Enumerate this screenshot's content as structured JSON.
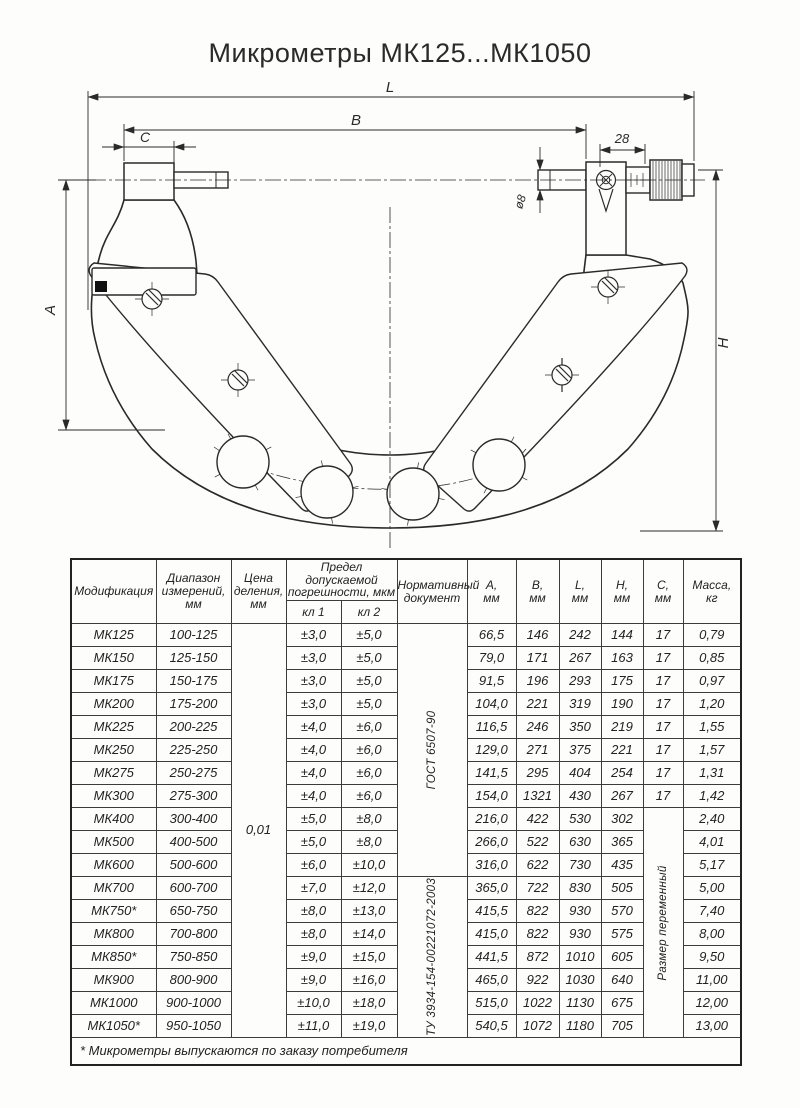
{
  "title": "Микрометры МК125...МК1050",
  "drawing": {
    "dim_L": "L",
    "dim_B": "B",
    "dim_C": "C",
    "dim_28": "28",
    "dim_d8": "ø8",
    "dim_A": "A",
    "dim_H": "H"
  },
  "table": {
    "headers": {
      "modification": "Модификация",
      "range": "Диапазон\nизмерений,\nмм",
      "division": "Цена\nделения,\nмм",
      "error_limit": "Предел допускаемой\nпогрешности, мкм",
      "class1": "кл 1",
      "class2": "кл 2",
      "document": "Нормативный\nдокумент",
      "a": "А,\nмм",
      "b": "В,\nмм",
      "l": "L,\nмм",
      "h": "Н,\nмм",
      "c": "С,\nмм",
      "mass": "Масса,\nкг"
    },
    "merged": {
      "price_division": "0,01",
      "doc1": {
        "label": "ГОСТ 6507-90",
        "rows": 11
      },
      "doc2": {
        "label": "ТУ 3934-154-00221072-2003",
        "rows": 7
      },
      "c_span": {
        "label": "Размер переменный",
        "start": 8,
        "rows": 10
      }
    },
    "rows": [
      {
        "mod": "МК125",
        "range": "100-125",
        "kl1": "±3,0",
        "kl2": "±5,0",
        "a": "66,5",
        "b": "146",
        "l": "242",
        "h": "144",
        "c": "17",
        "mass": "0,79"
      },
      {
        "mod": "МК150",
        "range": "125-150",
        "kl1": "±3,0",
        "kl2": "±5,0",
        "a": "79,0",
        "b": "171",
        "l": "267",
        "h": "163",
        "c": "17",
        "mass": "0,85"
      },
      {
        "mod": "МК175",
        "range": "150-175",
        "kl1": "±3,0",
        "kl2": "±5,0",
        "a": "91,5",
        "b": "196",
        "l": "293",
        "h": "175",
        "c": "17",
        "mass": "0,97"
      },
      {
        "mod": "МК200",
        "range": "175-200",
        "kl1": "±3,0",
        "kl2": "±5,0",
        "a": "104,0",
        "b": "221",
        "l": "319",
        "h": "190",
        "c": "17",
        "mass": "1,20"
      },
      {
        "mod": "МК225",
        "range": "200-225",
        "kl1": "±4,0",
        "kl2": "±6,0",
        "a": "116,5",
        "b": "246",
        "l": "350",
        "h": "219",
        "c": "17",
        "mass": "1,55"
      },
      {
        "mod": "МК250",
        "range": "225-250",
        "kl1": "±4,0",
        "kl2": "±6,0",
        "a": "129,0",
        "b": "271",
        "l": "375",
        "h": "221",
        "c": "17",
        "mass": "1,57"
      },
      {
        "mod": "МК275",
        "range": "250-275",
        "kl1": "±4,0",
        "kl2": "±6,0",
        "a": "141,5",
        "b": "295",
        "l": "404",
        "h": "254",
        "c": "17",
        "mass": "1,31"
      },
      {
        "mod": "МК300",
        "range": "275-300",
        "kl1": "±4,0",
        "kl2": "±6,0",
        "a": "154,0",
        "b": "1321",
        "l": "430",
        "h": "267",
        "c": "17",
        "mass": "1,42"
      },
      {
        "mod": "МК400",
        "range": "300-400",
        "kl1": "±5,0",
        "kl2": "±8,0",
        "a": "216,0",
        "b": "422",
        "l": "530",
        "h": "302",
        "c": null,
        "mass": "2,40"
      },
      {
        "mod": "МК500",
        "range": "400-500",
        "kl1": "±5,0",
        "kl2": "±8,0",
        "a": "266,0",
        "b": "522",
        "l": "630",
        "h": "365",
        "c": null,
        "mass": "4,01"
      },
      {
        "mod": "МК600",
        "range": "500-600",
        "kl1": "±6,0",
        "kl2": "±10,0",
        "a": "316,0",
        "b": "622",
        "l": "730",
        "h": "435",
        "c": null,
        "mass": "5,17"
      },
      {
        "mod": "МК700",
        "range": "600-700",
        "kl1": "±7,0",
        "kl2": "±12,0",
        "a": "365,0",
        "b": "722",
        "l": "830",
        "h": "505",
        "c": null,
        "mass": "5,00"
      },
      {
        "mod": "МК750*",
        "range": "650-750",
        "kl1": "±8,0",
        "kl2": "±13,0",
        "a": "415,5",
        "b": "822",
        "l": "930",
        "h": "570",
        "c": null,
        "mass": "7,40"
      },
      {
        "mod": "МК800",
        "range": "700-800",
        "kl1": "±8,0",
        "kl2": "±14,0",
        "a": "415,0",
        "b": "822",
        "l": "930",
        "h": "575",
        "c": null,
        "mass": "8,00"
      },
      {
        "mod": "МК850*",
        "range": "750-850",
        "kl1": "±9,0",
        "kl2": "±15,0",
        "a": "441,5",
        "b": "872",
        "l": "1010",
        "h": "605",
        "c": null,
        "mass": "9,50"
      },
      {
        "mod": "МК900",
        "range": "800-900",
        "kl1": "±9,0",
        "kl2": "±16,0",
        "a": "465,0",
        "b": "922",
        "l": "1030",
        "h": "640",
        "c": null,
        "mass": "11,00"
      },
      {
        "mod": "МК1000",
        "range": "900-1000",
        "kl1": "±10,0",
        "kl2": "±18,0",
        "a": "515,0",
        "b": "1022",
        "l": "1130",
        "h": "675",
        "c": null,
        "mass": "12,00"
      },
      {
        "mod": "МК1050*",
        "range": "950-1050",
        "kl1": "±11,0",
        "kl2": "±19,0",
        "a": "540,5",
        "b": "1072",
        "l": "1180",
        "h": "705",
        "c": null,
        "mass": "13,00"
      }
    ],
    "footnote": "* Микрометры выпускаются по заказу потребителя"
  }
}
